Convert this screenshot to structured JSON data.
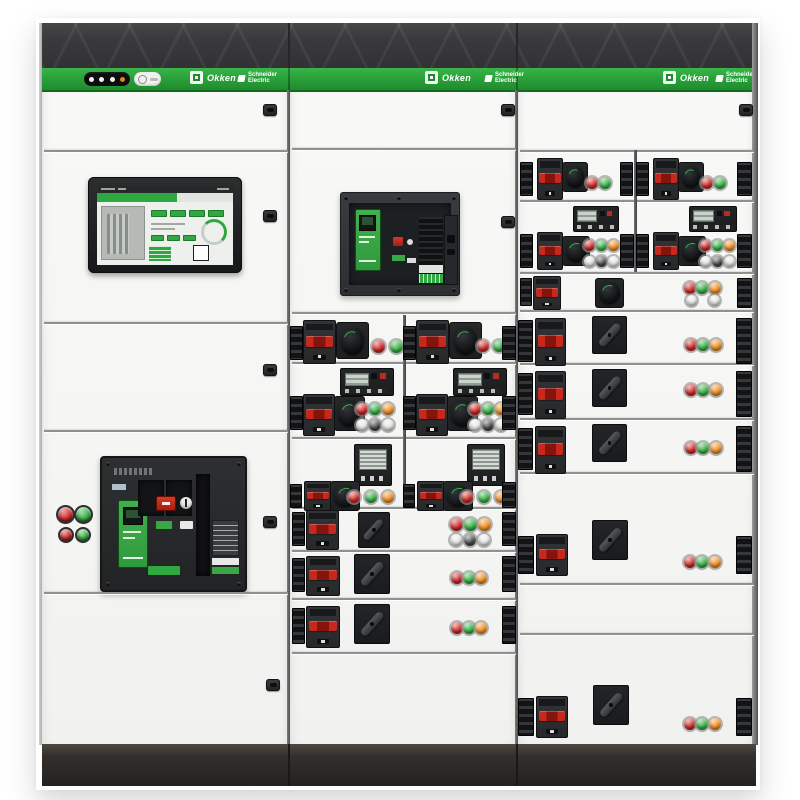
{
  "meta": {
    "subject": "Photograph of a three-section low-voltage electrical switchboard with withdrawable breaker drawers, touchscreen HMI and indicator lights"
  },
  "branding": {
    "product_name": "Okken",
    "manufacturer_line1": "Schneider",
    "manufacturer_line2": "Electric"
  },
  "indicator_pill": {
    "dots": [
      "white",
      "white",
      "white",
      "amber"
    ]
  },
  "palette": {
    "stripe_green": "#2aa23a",
    "brand_green": "#2fa841",
    "band_dark": "#3a3a3c",
    "plinth_dark": "#2b2927",
    "panel_white": "#f6f6f4",
    "led": {
      "red": "#cc2120",
      "green": "#2fae3d",
      "orange": "#ef8b1a",
      "white": "#eae9e7",
      "dark": "#414244",
      "gray": "#d8d8d6"
    }
  },
  "modules": [
    {
      "t": "seam",
      "x": 44,
      "y": 150,
      "w": 244
    },
    {
      "t": "seam",
      "x": 44,
      "y": 322,
      "w": 244
    },
    {
      "t": "seam",
      "x": 44,
      "y": 430,
      "w": 244
    },
    {
      "t": "seam",
      "x": 44,
      "y": 592,
      "w": 244
    },
    {
      "t": "seam",
      "x": 292,
      "y": 148,
      "w": 224
    },
    {
      "t": "seam",
      "x": 292,
      "y": 312,
      "w": 224
    },
    {
      "t": "seam",
      "x": 292,
      "y": 362,
      "w": 224
    },
    {
      "t": "seam",
      "x": 292,
      "y": 437,
      "w": 224
    },
    {
      "t": "seam",
      "x": 292,
      "y": 507,
      "w": 224
    },
    {
      "t": "seam",
      "x": 292,
      "y": 550,
      "w": 224
    },
    {
      "t": "seam",
      "x": 292,
      "y": 598,
      "w": 224
    },
    {
      "t": "seam",
      "x": 292,
      "y": 652,
      "w": 224
    },
    {
      "t": "seam",
      "x": 520,
      "y": 150,
      "w": 234
    },
    {
      "t": "seam",
      "x": 520,
      "y": 200,
      "w": 234
    },
    {
      "t": "seam",
      "x": 520,
      "y": 272,
      "w": 234
    },
    {
      "t": "seam",
      "x": 520,
      "y": 310,
      "w": 234
    },
    {
      "t": "seam",
      "x": 520,
      "y": 363,
      "w": 234
    },
    {
      "t": "seam",
      "x": 520,
      "y": 418,
      "w": 234
    },
    {
      "t": "seam",
      "x": 520,
      "y": 472,
      "w": 234
    },
    {
      "t": "seam",
      "x": 520,
      "y": 583,
      "w": 234
    },
    {
      "t": "seam",
      "x": 520,
      "y": 633,
      "w": 234
    },
    {
      "t": "vseam",
      "x": 403,
      "y": 315,
      "h": 192
    },
    {
      "t": "vseam",
      "x": 634,
      "y": 150,
      "h": 122
    },
    {
      "t": "lock",
      "x": 263,
      "y": 104
    },
    {
      "t": "lock",
      "x": 263,
      "y": 210
    },
    {
      "t": "lock",
      "x": 263,
      "y": 364
    },
    {
      "t": "lock",
      "x": 263,
      "y": 516
    },
    {
      "t": "lock",
      "x": 266,
      "y": 679
    },
    {
      "t": "lock",
      "x": 501,
      "y": 104
    },
    {
      "t": "lock",
      "x": 501,
      "y": 216
    },
    {
      "t": "lock",
      "x": 739,
      "y": 104
    },
    {
      "t": "pbtn",
      "x": 58,
      "y": 507,
      "d": 15,
      "c": "red"
    },
    {
      "t": "pbtn",
      "x": 76,
      "y": 507,
      "d": 15,
      "c": "green"
    },
    {
      "t": "pbtn",
      "x": 60,
      "y": 529,
      "d": 12,
      "c": "red"
    },
    {
      "t": "pbtn",
      "x": 77,
      "y": 529,
      "d": 12,
      "c": "green"
    },
    {
      "t": "conn",
      "x": 290,
      "y": 326,
      "w": 13,
      "h": 34
    },
    {
      "t": "bk",
      "x": 303,
      "y": 320,
      "w": 31,
      "h": 42
    },
    {
      "t": "rot",
      "x": 336,
      "y": 322,
      "w": 31,
      "h": 35
    },
    {
      "t": "led",
      "x": 372,
      "y": 340,
      "d": 13,
      "c": "red"
    },
    {
      "t": "led",
      "x": 390,
      "y": 340,
      "d": 13,
      "c": "green"
    },
    {
      "t": "conn",
      "x": 403,
      "y": 326,
      "w": 13,
      "h": 34
    },
    {
      "t": "bk",
      "x": 416,
      "y": 320,
      "w": 31,
      "h": 42
    },
    {
      "t": "rot",
      "x": 449,
      "y": 322,
      "w": 31,
      "h": 35
    },
    {
      "t": "led",
      "x": 477,
      "y": 340,
      "d": 12,
      "c": "red"
    },
    {
      "t": "led",
      "x": 493,
      "y": 340,
      "d": 12,
      "c": "green"
    },
    {
      "t": "conn",
      "x": 502,
      "y": 326,
      "w": 14,
      "h": 34
    },
    {
      "t": "mw",
      "x": 340,
      "y": 368,
      "w": 52,
      "h": 26
    },
    {
      "t": "conn",
      "x": 290,
      "y": 396,
      "w": 13,
      "h": 34
    },
    {
      "t": "bk",
      "x": 303,
      "y": 394,
      "w": 30,
      "h": 40
    },
    {
      "t": "rot",
      "x": 334,
      "y": 396,
      "w": 29,
      "h": 33
    },
    {
      "t": "led",
      "x": 356,
      "y": 403,
      "d": 12,
      "c": "red"
    },
    {
      "t": "led",
      "x": 369,
      "y": 403,
      "d": 12,
      "c": "green"
    },
    {
      "t": "led",
      "x": 382,
      "y": 403,
      "d": 12,
      "c": "orange"
    },
    {
      "t": "led",
      "x": 356,
      "y": 419,
      "d": 12,
      "c": "white"
    },
    {
      "t": "led",
      "x": 369,
      "y": 419,
      "d": 12,
      "c": "dark"
    },
    {
      "t": "led",
      "x": 382,
      "y": 419,
      "d": 12,
      "c": "white"
    },
    {
      "t": "mw",
      "x": 453,
      "y": 368,
      "w": 52,
      "h": 26
    },
    {
      "t": "conn",
      "x": 403,
      "y": 396,
      "w": 13,
      "h": 34
    },
    {
      "t": "bk",
      "x": 416,
      "y": 394,
      "w": 30,
      "h": 40
    },
    {
      "t": "rot",
      "x": 447,
      "y": 396,
      "w": 29,
      "h": 33
    },
    {
      "t": "led",
      "x": 469,
      "y": 403,
      "d": 12,
      "c": "red"
    },
    {
      "t": "led",
      "x": 482,
      "y": 403,
      "d": 12,
      "c": "green"
    },
    {
      "t": "led",
      "x": 495,
      "y": 403,
      "d": 12,
      "c": "orange"
    },
    {
      "t": "led",
      "x": 469,
      "y": 419,
      "d": 12,
      "c": "white"
    },
    {
      "t": "led",
      "x": 482,
      "y": 419,
      "d": 12,
      "c": "dark"
    },
    {
      "t": "led",
      "x": 495,
      "y": 419,
      "d": 12,
      "c": "white"
    },
    {
      "t": "conn",
      "x": 502,
      "y": 396,
      "w": 14,
      "h": 34
    },
    {
      "t": "ms",
      "x": 354,
      "y": 444,
      "w": 36,
      "h": 40
    },
    {
      "t": "conn",
      "x": 290,
      "y": 484,
      "w": 12,
      "h": 24
    },
    {
      "t": "bk",
      "x": 304,
      "y": 481,
      "w": 26,
      "h": 28
    },
    {
      "t": "rot",
      "x": 330,
      "y": 481,
      "w": 28,
      "h": 28
    },
    {
      "t": "led",
      "x": 348,
      "y": 491,
      "d": 12,
      "c": "red"
    },
    {
      "t": "led",
      "x": 365,
      "y": 491,
      "d": 12,
      "c": "green"
    },
    {
      "t": "led",
      "x": 382,
      "y": 491,
      "d": 12,
      "c": "orange"
    },
    {
      "t": "ms",
      "x": 467,
      "y": 444,
      "w": 36,
      "h": 40
    },
    {
      "t": "conn",
      "x": 403,
      "y": 484,
      "w": 12,
      "h": 24
    },
    {
      "t": "bk",
      "x": 417,
      "y": 481,
      "w": 26,
      "h": 28
    },
    {
      "t": "rot",
      "x": 443,
      "y": 481,
      "w": 28,
      "h": 28
    },
    {
      "t": "led",
      "x": 461,
      "y": 491,
      "d": 12,
      "c": "red"
    },
    {
      "t": "led",
      "x": 478,
      "y": 491,
      "d": 12,
      "c": "green"
    },
    {
      "t": "led",
      "x": 495,
      "y": 491,
      "d": 12,
      "c": "orange"
    },
    {
      "t": "conn",
      "x": 502,
      "y": 482,
      "w": 14,
      "h": 26
    },
    {
      "t": "conn",
      "x": 292,
      "y": 512,
      "w": 13,
      "h": 34
    },
    {
      "t": "bk",
      "x": 306,
      "y": 510,
      "w": 31,
      "h": 38
    },
    {
      "t": "rotd",
      "x": 358,
      "y": 512,
      "w": 30,
      "h": 34
    },
    {
      "t": "led",
      "x": 450,
      "y": 518,
      "d": 13,
      "c": "red"
    },
    {
      "t": "led",
      "x": 464,
      "y": 518,
      "d": 13,
      "c": "green"
    },
    {
      "t": "led",
      "x": 478,
      "y": 518,
      "d": 13,
      "c": "orange"
    },
    {
      "t": "led",
      "x": 450,
      "y": 534,
      "d": 12,
      "c": "white"
    },
    {
      "t": "led",
      "x": 464,
      "y": 534,
      "d": 12,
      "c": "dark"
    },
    {
      "t": "led",
      "x": 478,
      "y": 534,
      "d": 12,
      "c": "white"
    },
    {
      "t": "conn",
      "x": 502,
      "y": 512,
      "w": 14,
      "h": 34
    },
    {
      "t": "conn",
      "x": 292,
      "y": 558,
      "w": 13,
      "h": 34
    },
    {
      "t": "bk",
      "x": 306,
      "y": 556,
      "w": 32,
      "h": 38
    },
    {
      "t": "rotd",
      "x": 354,
      "y": 554,
      "w": 34,
      "h": 38
    },
    {
      "t": "led",
      "x": 451,
      "y": 572,
      "d": 12,
      "c": "red"
    },
    {
      "t": "led",
      "x": 463,
      "y": 572,
      "d": 12,
      "c": "green"
    },
    {
      "t": "led",
      "x": 475,
      "y": 572,
      "d": 12,
      "c": "orange"
    },
    {
      "t": "conn",
      "x": 502,
      "y": 556,
      "w": 14,
      "h": 36
    },
    {
      "t": "conn",
      "x": 292,
      "y": 608,
      "w": 13,
      "h": 36
    },
    {
      "t": "bk",
      "x": 306,
      "y": 606,
      "w": 32,
      "h": 40
    },
    {
      "t": "rotd",
      "x": 354,
      "y": 604,
      "w": 34,
      "h": 38
    },
    {
      "t": "led",
      "x": 451,
      "y": 622,
      "d": 12,
      "c": "red"
    },
    {
      "t": "led",
      "x": 463,
      "y": 622,
      "d": 12,
      "c": "green"
    },
    {
      "t": "led",
      "x": 475,
      "y": 622,
      "d": 12,
      "c": "orange"
    },
    {
      "t": "conn",
      "x": 502,
      "y": 606,
      "w": 14,
      "h": 38
    },
    {
      "t": "conn",
      "x": 520,
      "y": 162,
      "w": 13,
      "h": 34
    },
    {
      "t": "bk",
      "x": 537,
      "y": 158,
      "w": 24,
      "h": 40
    },
    {
      "t": "rot",
      "x": 562,
      "y": 162,
      "w": 24,
      "h": 28
    },
    {
      "t": "led",
      "x": 586,
      "y": 177,
      "d": 12,
      "c": "red"
    },
    {
      "t": "led",
      "x": 599,
      "y": 177,
      "d": 12,
      "c": "green"
    },
    {
      "t": "conn",
      "x": 620,
      "y": 162,
      "w": 13,
      "h": 34
    },
    {
      "t": "conn",
      "x": 636,
      "y": 162,
      "w": 13,
      "h": 34
    },
    {
      "t": "bk",
      "x": 653,
      "y": 158,
      "w": 24,
      "h": 40
    },
    {
      "t": "rot",
      "x": 678,
      "y": 162,
      "w": 24,
      "h": 28
    },
    {
      "t": "led",
      "x": 701,
      "y": 177,
      "d": 12,
      "c": "red"
    },
    {
      "t": "led",
      "x": 714,
      "y": 177,
      "d": 12,
      "c": "green"
    },
    {
      "t": "conn",
      "x": 737,
      "y": 162,
      "w": 15,
      "h": 34
    },
    {
      "t": "mw",
      "x": 573,
      "y": 206,
      "w": 44,
      "h": 24
    },
    {
      "t": "conn",
      "x": 520,
      "y": 234,
      "w": 13,
      "h": 34
    },
    {
      "t": "bk",
      "x": 537,
      "y": 232,
      "w": 24,
      "h": 36
    },
    {
      "t": "rot",
      "x": 562,
      "y": 236,
      "w": 26,
      "h": 28
    },
    {
      "t": "led",
      "x": 584,
      "y": 240,
      "d": 11,
      "c": "red"
    },
    {
      "t": "led",
      "x": 596,
      "y": 240,
      "d": 11,
      "c": "green"
    },
    {
      "t": "led",
      "x": 608,
      "y": 240,
      "d": 11,
      "c": "orange"
    },
    {
      "t": "led",
      "x": 584,
      "y": 256,
      "d": 11,
      "c": "white"
    },
    {
      "t": "led",
      "x": 596,
      "y": 256,
      "d": 11,
      "c": "dark"
    },
    {
      "t": "led",
      "x": 608,
      "y": 256,
      "d": 11,
      "c": "white"
    },
    {
      "t": "conn",
      "x": 620,
      "y": 234,
      "w": 14,
      "h": 34
    },
    {
      "t": "mw",
      "x": 689,
      "y": 206,
      "w": 46,
      "h": 24
    },
    {
      "t": "conn",
      "x": 636,
      "y": 234,
      "w": 13,
      "h": 34
    },
    {
      "t": "bk",
      "x": 653,
      "y": 232,
      "w": 24,
      "h": 36
    },
    {
      "t": "rot",
      "x": 678,
      "y": 236,
      "w": 26,
      "h": 28
    },
    {
      "t": "led",
      "x": 700,
      "y": 240,
      "d": 11,
      "c": "red"
    },
    {
      "t": "led",
      "x": 712,
      "y": 240,
      "d": 11,
      "c": "green"
    },
    {
      "t": "led",
      "x": 724,
      "y": 240,
      "d": 11,
      "c": "orange"
    },
    {
      "t": "led",
      "x": 700,
      "y": 256,
      "d": 11,
      "c": "white"
    },
    {
      "t": "led",
      "x": 712,
      "y": 256,
      "d": 11,
      "c": "dark"
    },
    {
      "t": "led",
      "x": 724,
      "y": 256,
      "d": 11,
      "c": "white"
    },
    {
      "t": "conn",
      "x": 737,
      "y": 234,
      "w": 15,
      "h": 34
    },
    {
      "t": "conn",
      "x": 520,
      "y": 278,
      "w": 12,
      "h": 28
    },
    {
      "t": "bk",
      "x": 533,
      "y": 276,
      "w": 26,
      "h": 32
    },
    {
      "t": "rot",
      "x": 595,
      "y": 278,
      "w": 27,
      "h": 28
    },
    {
      "t": "led",
      "x": 684,
      "y": 282,
      "d": 12,
      "c": "red"
    },
    {
      "t": "led",
      "x": 696,
      "y": 282,
      "d": 12,
      "c": "green"
    },
    {
      "t": "led",
      "x": 709,
      "y": 282,
      "d": 12,
      "c": "orange"
    },
    {
      "t": "led",
      "x": 686,
      "y": 295,
      "d": 11,
      "c": "white"
    },
    {
      "t": "led",
      "x": 709,
      "y": 295,
      "d": 11,
      "c": "white"
    },
    {
      "t": "conn",
      "x": 737,
      "y": 278,
      "w": 15,
      "h": 30
    },
    {
      "t": "conn",
      "x": 518,
      "y": 320,
      "w": 15,
      "h": 42
    },
    {
      "t": "bk",
      "x": 535,
      "y": 318,
      "w": 29,
      "h": 46
    },
    {
      "t": "rotd",
      "x": 592,
      "y": 316,
      "w": 33,
      "h": 36
    },
    {
      "t": "led",
      "x": 685,
      "y": 339,
      "d": 12,
      "c": "red"
    },
    {
      "t": "led",
      "x": 697,
      "y": 339,
      "d": 12,
      "c": "green"
    },
    {
      "t": "led",
      "x": 710,
      "y": 339,
      "d": 12,
      "c": "orange"
    },
    {
      "t": "conn",
      "x": 736,
      "y": 318,
      "w": 16,
      "h": 46
    },
    {
      "t": "conn",
      "x": 518,
      "y": 373,
      "w": 15,
      "h": 42
    },
    {
      "t": "bk",
      "x": 535,
      "y": 371,
      "w": 29,
      "h": 46
    },
    {
      "t": "rotd",
      "x": 592,
      "y": 369,
      "w": 33,
      "h": 36
    },
    {
      "t": "led",
      "x": 685,
      "y": 384,
      "d": 12,
      "c": "red"
    },
    {
      "t": "led",
      "x": 697,
      "y": 384,
      "d": 12,
      "c": "green"
    },
    {
      "t": "led",
      "x": 710,
      "y": 384,
      "d": 12,
      "c": "orange"
    },
    {
      "t": "conn",
      "x": 736,
      "y": 371,
      "w": 16,
      "h": 46
    },
    {
      "t": "conn",
      "x": 518,
      "y": 428,
      "w": 15,
      "h": 42
    },
    {
      "t": "bk",
      "x": 535,
      "y": 426,
      "w": 29,
      "h": 46
    },
    {
      "t": "rotd",
      "x": 592,
      "y": 424,
      "w": 33,
      "h": 36
    },
    {
      "t": "led",
      "x": 685,
      "y": 442,
      "d": 12,
      "c": "red"
    },
    {
      "t": "led",
      "x": 697,
      "y": 442,
      "d": 12,
      "c": "green"
    },
    {
      "t": "led",
      "x": 710,
      "y": 442,
      "d": 12,
      "c": "orange"
    },
    {
      "t": "conn",
      "x": 736,
      "y": 426,
      "w": 16,
      "h": 46
    },
    {
      "t": "rotd",
      "x": 592,
      "y": 520,
      "w": 34,
      "h": 38
    },
    {
      "t": "conn",
      "x": 518,
      "y": 536,
      "w": 16,
      "h": 38
    },
    {
      "t": "bk",
      "x": 536,
      "y": 534,
      "w": 30,
      "h": 40
    },
    {
      "t": "led",
      "x": 684,
      "y": 556,
      "d": 12,
      "c": "red"
    },
    {
      "t": "led",
      "x": 696,
      "y": 556,
      "d": 12,
      "c": "green"
    },
    {
      "t": "led",
      "x": 709,
      "y": 556,
      "d": 12,
      "c": "orange"
    },
    {
      "t": "conn",
      "x": 736,
      "y": 536,
      "w": 16,
      "h": 38
    },
    {
      "t": "rotd",
      "x": 593,
      "y": 685,
      "w": 34,
      "h": 38
    },
    {
      "t": "conn",
      "x": 518,
      "y": 698,
      "w": 16,
      "h": 38
    },
    {
      "t": "bk",
      "x": 536,
      "y": 696,
      "w": 30,
      "h": 40
    },
    {
      "t": "led",
      "x": 684,
      "y": 718,
      "d": 12,
      "c": "red"
    },
    {
      "t": "led",
      "x": 696,
      "y": 718,
      "d": 12,
      "c": "green"
    },
    {
      "t": "led",
      "x": 709,
      "y": 718,
      "d": 12,
      "c": "orange"
    },
    {
      "t": "conn",
      "x": 736,
      "y": 698,
      "w": 16,
      "h": 38
    }
  ]
}
